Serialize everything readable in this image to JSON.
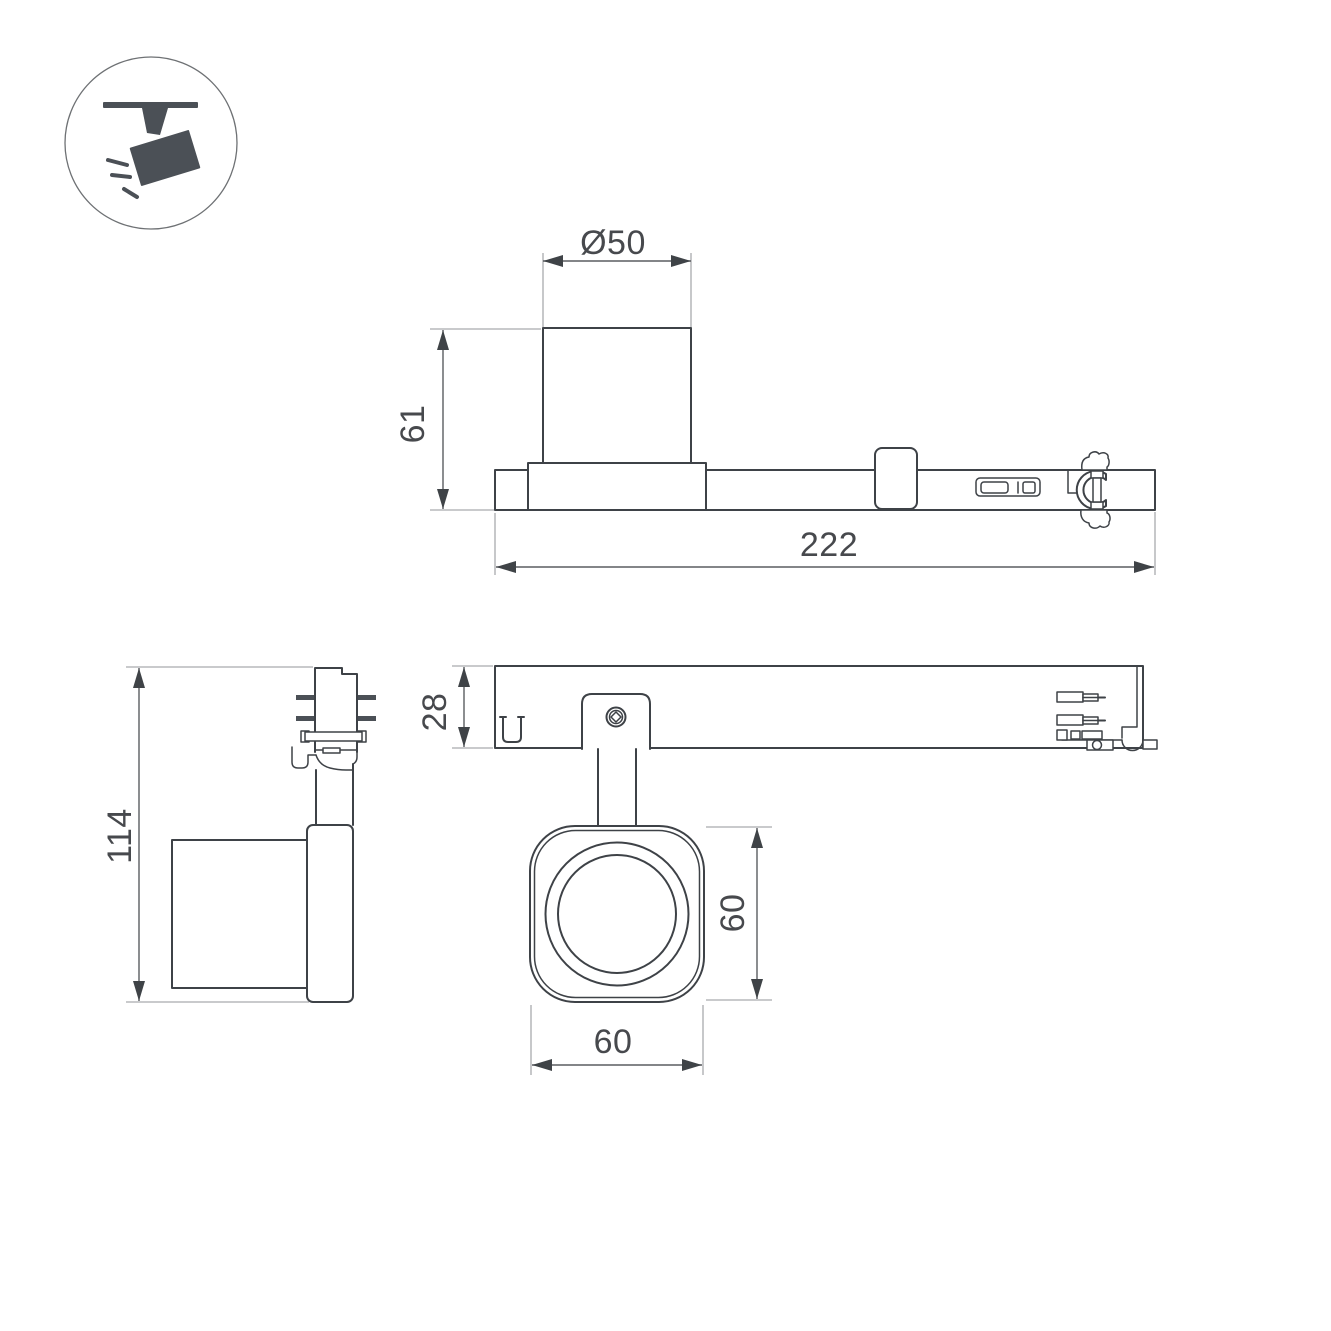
{
  "page": {
    "background": "#ffffff"
  },
  "icon": {
    "name": "track-spotlight-icon"
  },
  "dimensions": {
    "side_view": {
      "diameter": "Ø50",
      "height": "61",
      "length": "222"
    },
    "end_view": {
      "total_height": "114"
    },
    "plan_view": {
      "depth": "28"
    },
    "front_view": {
      "height": "60",
      "width": "60"
    }
  },
  "colors": {
    "outline": "#3e4247",
    "dark_fill": "#4b5056",
    "dimension_line": "#5a5d61",
    "extension_line": "#a9abae",
    "text": "#47494d"
  }
}
